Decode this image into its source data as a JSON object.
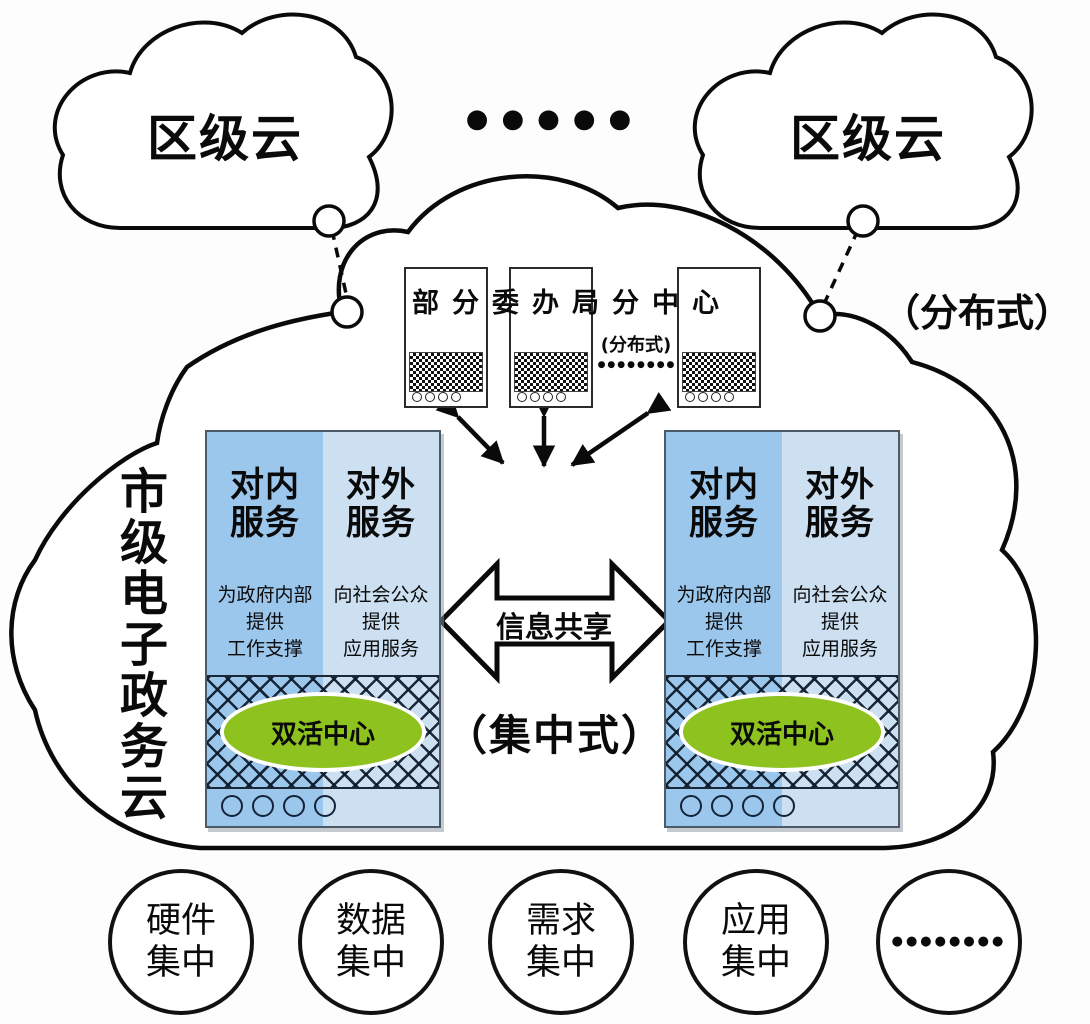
{
  "colors": {
    "panel_inner_blue": "#9CC7EC",
    "panel_outer_blue": "#CCE0F2",
    "dual_active_green": "#8DC21F",
    "outline": "#0a0a0a"
  },
  "top": {
    "left_cloud": {
      "label": "区级云"
    },
    "right_cloud": {
      "label": "区级云"
    },
    "dots": "●●●●●"
  },
  "distributed_outer_label": "（分布式）",
  "subcenters": {
    "title": "部分委办局分中心",
    "distributed_label": "(分布式)",
    "dots": "●●●●●●●●"
  },
  "city_cloud": {
    "label": "市级电子政务云"
  },
  "panel_left": {
    "internal_title": "对内\n服务",
    "internal_desc": "为政府内部\n提供\n工作支撑",
    "external_title": "对外\n服务",
    "external_desc": "向社会公众\n提供\n应用服务",
    "dual_active": "双活中心"
  },
  "panel_right": {
    "internal_title": "对内\n服务",
    "internal_desc": "为政府内部\n提供\n工作支撑",
    "external_title": "对外\n服务",
    "external_desc": "向社会公众\n提供\n应用服务",
    "dual_active": "双活中心"
  },
  "center": {
    "info_share": "信息共享",
    "centralized": "（集中式）"
  },
  "bottom": {
    "items": [
      {
        "label": "硬件\n集中"
      },
      {
        "label": "数据\n集中"
      },
      {
        "label": "需求\n集中"
      },
      {
        "label": "应用\n集中"
      },
      {
        "label": "●●●●●●●●"
      }
    ]
  }
}
